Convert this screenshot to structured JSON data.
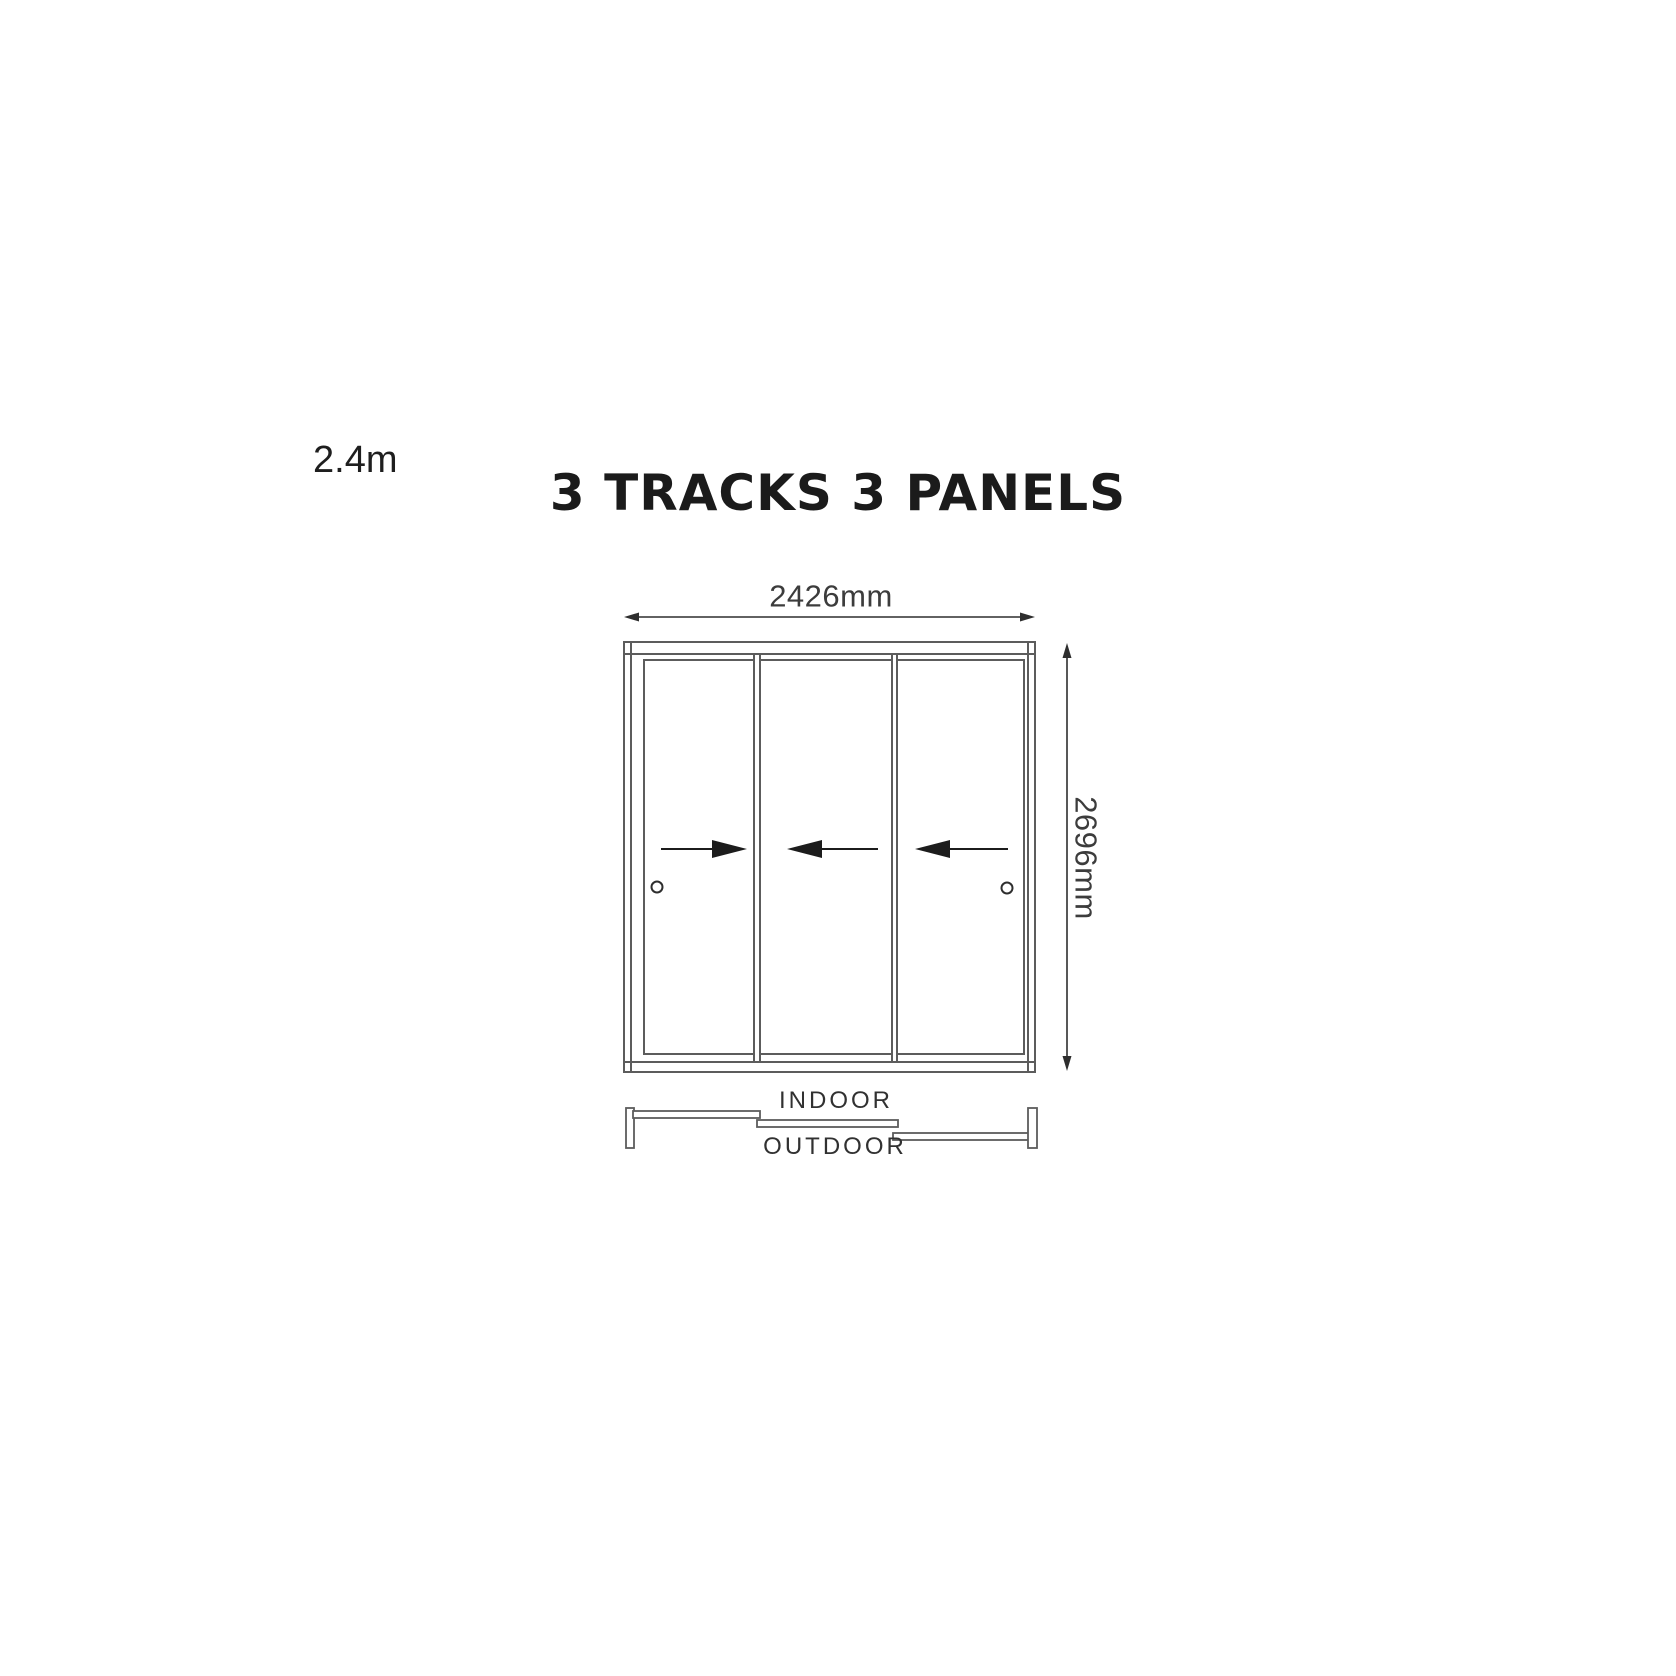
{
  "page": {
    "background": "#ffffff",
    "size_label": "2.4m",
    "title": "3 TRACKS 3 PANELS"
  },
  "dimensions": {
    "width_label": "2426mm",
    "height_label": "2696mm"
  },
  "plan": {
    "indoor_label": "INDOOR",
    "outdoor_label": "OUTDOOR"
  },
  "diagram": {
    "type": "sliding-door-elevation-and-track-plan",
    "tracks": 3,
    "panels": 3,
    "panel_slide_directions": [
      "right",
      "left",
      "left"
    ],
    "handles": 2
  },
  "colors": {
    "frame_line": "#5c5c5c",
    "dimension_line": "#2e2e2e",
    "arrow_fill": "#1c1c1c",
    "title_text": "#1b1b1b",
    "dimension_text": "#3c3c3c",
    "plan_label_text": "#313131"
  }
}
